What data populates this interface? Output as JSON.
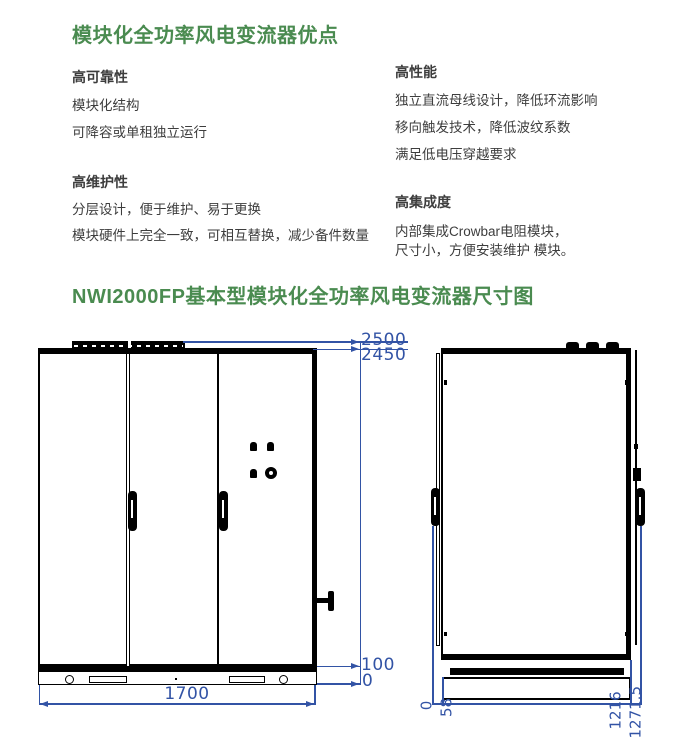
{
  "colors": {
    "title_green": "#4a8b50",
    "dimension_blue": "#3253a5",
    "body_text": "#3d3d3d",
    "drawing_black": "#000000"
  },
  "section1": {
    "title": "模块化全功率风电变流器优点",
    "left": {
      "block1": {
        "heading": "高可靠性",
        "line1": "模块化结构",
        "line2": "可降容或单租独立运行"
      },
      "block2": {
        "heading": "高维护性",
        "line1": "分层设计，便于维护、易于更换",
        "line2": "模块硬件上完全一致，可相互替换，减少备件数量"
      }
    },
    "right": {
      "block1": {
        "heading": "高性能",
        "line1": "独立直流母线设计，降低环流影响",
        "line2": "移向触发技术，降低波纹系数",
        "line3": "满足低电压穿越要求"
      },
      "block2": {
        "heading": "高集成度",
        "line1": "内部集成Crowbar电阻模块，",
        "line2": "尺寸小，方便安装维护 模块。"
      }
    }
  },
  "section2": {
    "title": "NWI2000FP基本型模块化全功率风电变流器尺寸图",
    "front_view": {
      "dim_height_total": "2500",
      "dim_height_body": "2450",
      "dim_base_top": "100",
      "dim_base_bottom": "0",
      "dim_width": "1700"
    },
    "side_view": {
      "dim_depth_zero": "0",
      "dim_depth_door": "58",
      "dim_depth_body": "1216",
      "dim_depth_total": "1271.5"
    }
  }
}
